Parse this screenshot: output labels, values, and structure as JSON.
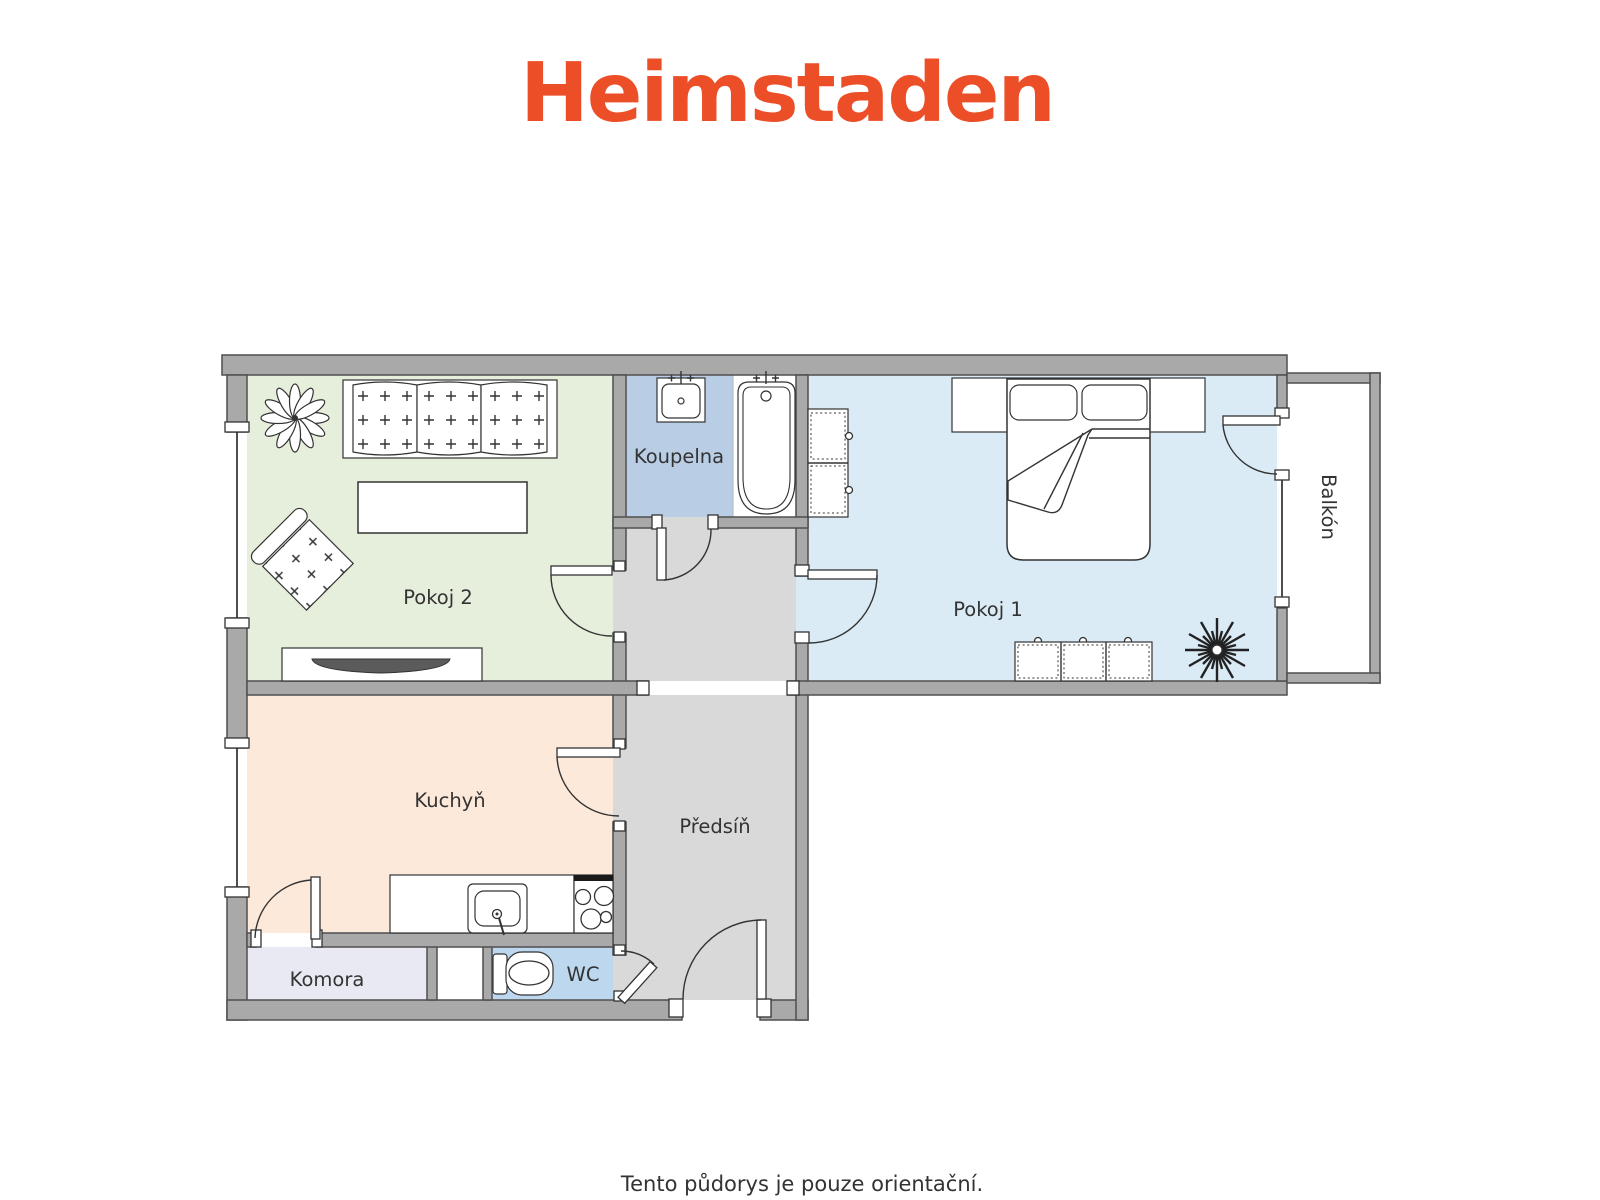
{
  "brand": {
    "logo": "Heimstaden",
    "color": "#EC4E27"
  },
  "disclaimer": "Tento půdorys je pouze orientační.",
  "rooms": {
    "pokoj2": {
      "label": "Pokoj 2",
      "floor": "#E6EEDC"
    },
    "koupelna": {
      "label": "Koupelna",
      "floor": "#B9CEE5"
    },
    "pokoj1": {
      "label": "Pokoj 1",
      "floor": "#DAEBF6"
    },
    "balkon": {
      "label": "Balkón",
      "floor": "#FFFFFF"
    },
    "kuchyn": {
      "label": "Kuchyň",
      "floor": "#FCE9DA"
    },
    "predsin": {
      "label": "Předsíň",
      "floor": "#D9D9D9"
    },
    "komora": {
      "label": "Komora",
      "floor": "#E9E9F3"
    },
    "wc": {
      "label": "WC",
      "floor": "#BDD7EE"
    }
  },
  "icons": {
    "plant_flower": "flower-plant-icon",
    "plant_burst": "starburst-plant-icon",
    "sofa": "sofa-icon",
    "armchair": "armchair-icon",
    "coffee_table": "coffee-table-icon",
    "tv_stand": "tv-stand-icon",
    "double_bed": "double-bed-icon",
    "wardrobe": "wardrobe-icon",
    "dresser": "dresser-icon",
    "bathtub": "bathtub-icon",
    "washbasin": "washbasin-icon",
    "kitchen_sink": "kitchen-sink-icon",
    "stove": "stove-icon",
    "toilet": "toilet-icon"
  }
}
